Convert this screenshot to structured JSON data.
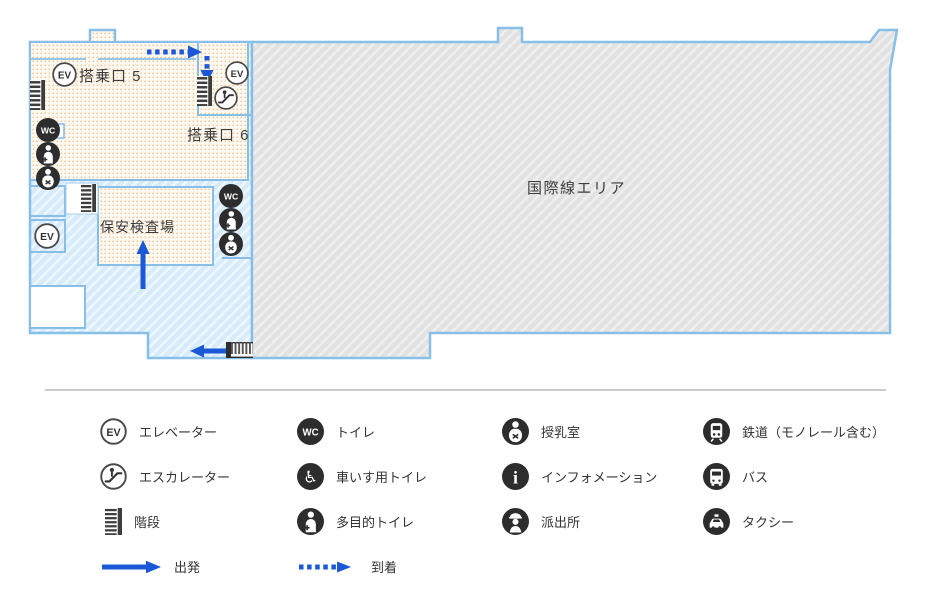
{
  "map": {
    "labels": {
      "gate5": "搭乗口 5",
      "gate6": "搭乗口 6",
      "security_checkpoint": "保安検査場",
      "international_area": "国際線エリア"
    }
  },
  "legend": {
    "columns": [
      {
        "items": [
          {
            "icon": "elevator-icon",
            "label": "エレベーター"
          },
          {
            "icon": "escalator-icon",
            "label": "エスカレーター"
          },
          {
            "icon": "stairs-icon",
            "label": "階段"
          },
          {
            "icon": "departure-arrow-icon",
            "label": "出発"
          }
        ]
      },
      {
        "items": [
          {
            "icon": "toilet-icon",
            "label": "トイレ"
          },
          {
            "icon": "wheelchair-toilet-icon",
            "label": "車いす用トイレ"
          },
          {
            "icon": "multipurpose-toilet-icon",
            "label": "多目的トイレ"
          },
          {
            "icon": "arrival-arrow-icon",
            "label": "到着"
          }
        ]
      },
      {
        "items": [
          {
            "icon": "nursing-room-icon",
            "label": "授乳室"
          },
          {
            "icon": "information-icon",
            "label": "インフォメーション"
          },
          {
            "icon": "police-box-icon",
            "label": "派出所"
          }
        ]
      },
      {
        "items": [
          {
            "icon": "train-icon",
            "label": "鉄道（モノレール含む）"
          },
          {
            "icon": "bus-icon",
            "label": "バス"
          },
          {
            "icon": "taxi-icon",
            "label": "タクシー"
          }
        ]
      }
    ]
  },
  "colors": {
    "arrow_blue": "#1b58d6",
    "border_blue": "#88bfe9",
    "departure_area_fill": "#fdf8f0",
    "departure_area_dot": "#f2c695",
    "landside_area_fill": "#d7ebfa",
    "international_area_fill": "#e3e3e3",
    "icon_dark": "#2d2d2d"
  }
}
